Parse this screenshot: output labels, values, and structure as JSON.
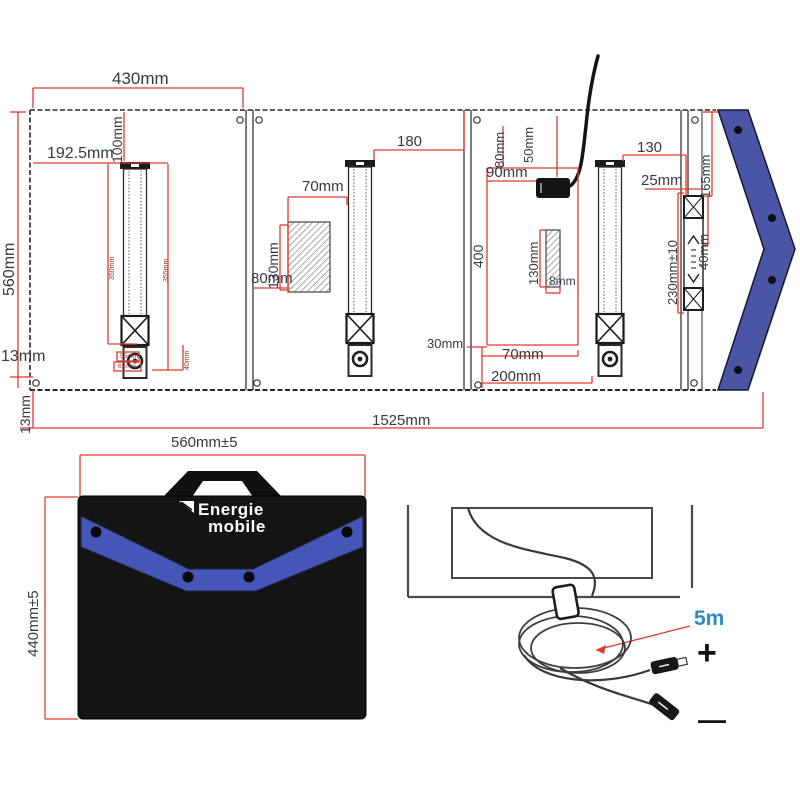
{
  "colors": {
    "dimension_red": "#e03a2f",
    "flap_blue": "#4a55a6",
    "band_blue": "#4656b8",
    "line_black": "#23262a",
    "cable_label_blue": "#2b8ac4"
  },
  "icons": {
    "brand_flag": "triangle-flag-icon"
  },
  "unfolded": {
    "top_width": "430mm",
    "left_height": "560mm",
    "leg1_offset": "192.5mm",
    "leg1_top_gap": "100mm",
    "bottom_left_gap": "13mm",
    "bottom_left_gap_vertical": "13mm",
    "leg_inner_left": "350mm",
    "leg_inner_right": "355mm",
    "foot_height": "40mm",
    "foot_width_inner": "55mm",
    "foot_width_outer": "62mm",
    "panel2_leg_gap": "180",
    "panel2_box_width": "70mm",
    "panel2_box_height": "130mm",
    "panel2_box_bottom": "80mm",
    "panel3_top_gap": "80mm",
    "panel3_cable_gap": "50mm",
    "panel3_connector_width": "90mm",
    "panel3_inner_height": "400",
    "panel3_strip_height": "130mm",
    "panel3_strip_width": "8mm",
    "panel3_bottom_gap": "30mm",
    "panel3_bottom_width1": "70mm",
    "panel3_bottom_width2": "200mm",
    "panel4_leg_gap": "130",
    "panel4_strap_gap": "25mm",
    "panel4_edge_height": "165mm",
    "panel4_strap_length": "230mm±10",
    "panel4_strap_segment": "40mm",
    "total_width": "1525mm"
  },
  "folded": {
    "width": "560mm±5",
    "height": "440mm±5",
    "brand_line1": "Energie",
    "brand_line2": "mobile"
  },
  "cable": {
    "length_label": "5m",
    "polarity_plus": "+",
    "polarity_minus": "—"
  }
}
